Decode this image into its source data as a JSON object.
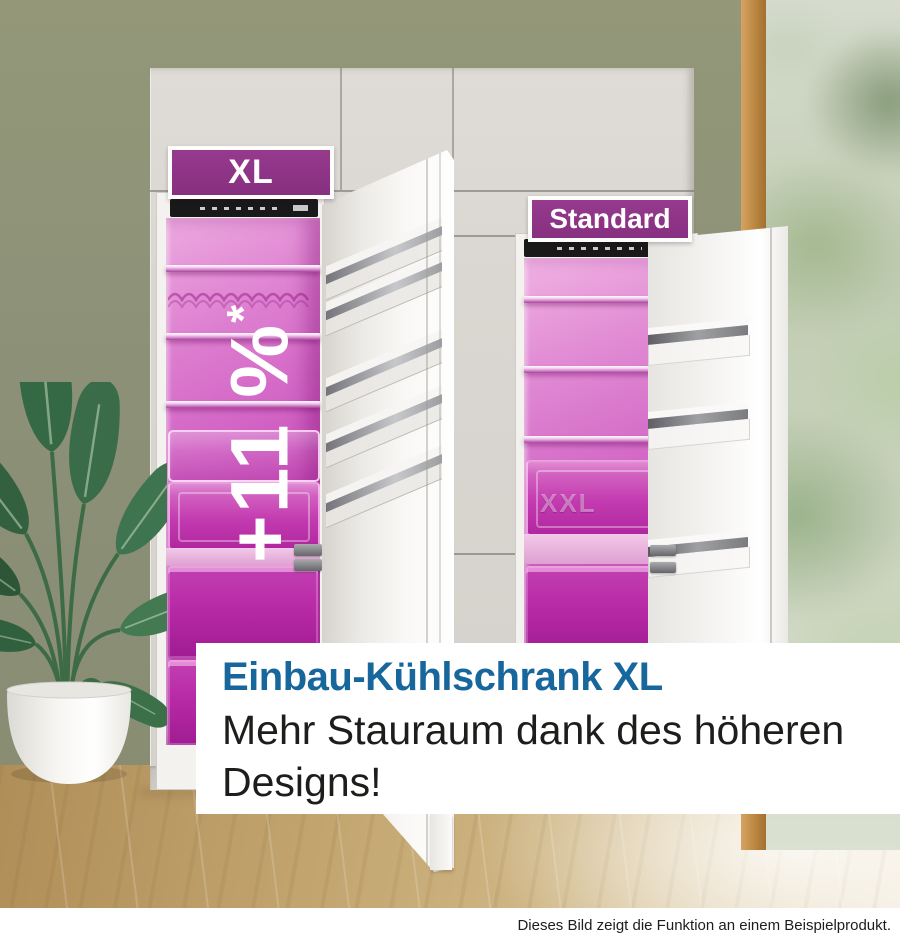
{
  "scene": {
    "badge_xl": "XL",
    "badge_standard": "Standard",
    "overlay_stat": {
      "text": "+11 %",
      "asterisk": "*"
    },
    "caption": {
      "headline": "Einbau-Kühlschrank XL",
      "body_line1": "Mehr Stauraum dank des höheren",
      "body_line2": "Designs!"
    },
    "drawer_label_xxl": "XXL",
    "disclaimer": "Dieses Bild zeigt die Funktion an einem Beispielprodukt.",
    "colors": {
      "accent_purple": "#8e3186",
      "interior_magenta": "#c648b6",
      "headline_blue": "#17679d",
      "wall_green": "#8c9077",
      "floor_wood": "#c2a46e"
    }
  }
}
